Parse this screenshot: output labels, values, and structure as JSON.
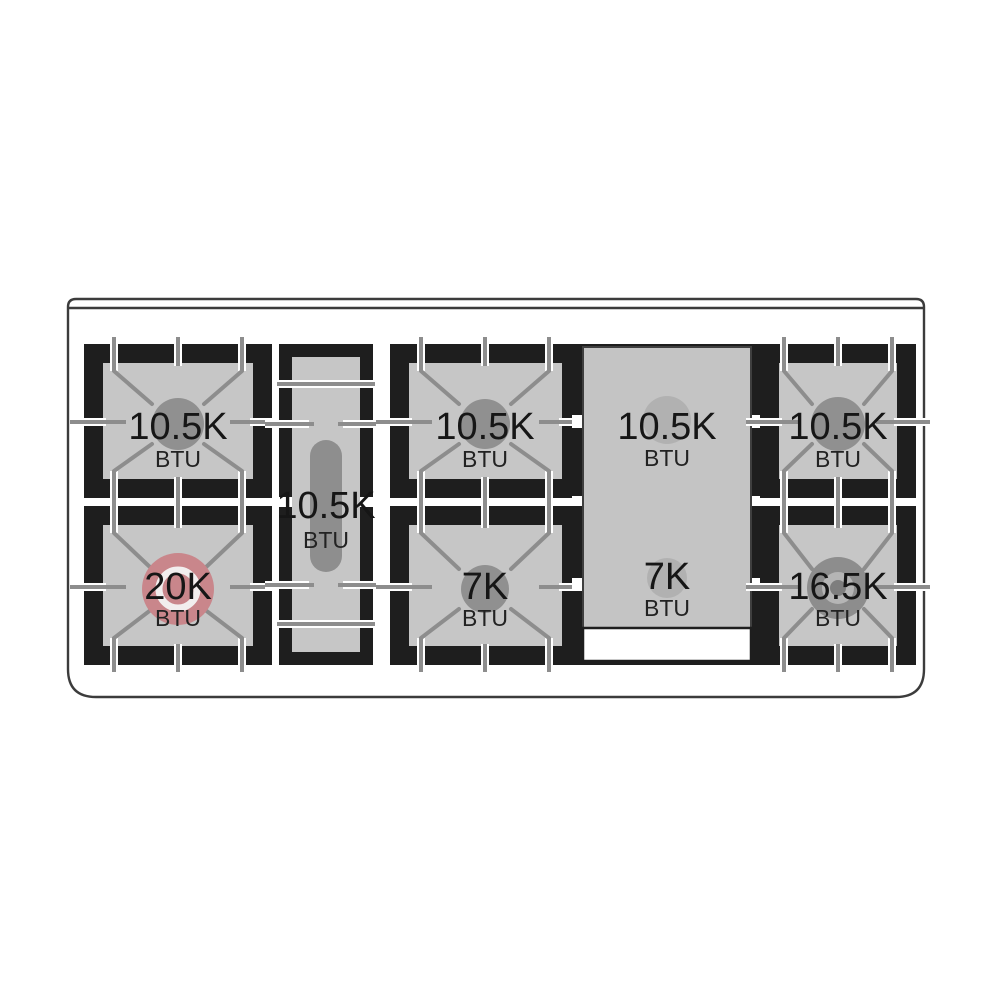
{
  "figure": {
    "kind": "range-cooktop-burner-diagram"
  },
  "colors": {
    "frame": "#1e1e1e",
    "surface": "#c6c6c6",
    "grate_line": "#8d8d8d",
    "burner_gray": "#909090",
    "burner_red": "#c9868b",
    "burner_red_ring": "#f2eeee",
    "dual_outer": "#8d8d8d",
    "dual_mid": "#b5b5b5",
    "dual_center": "#7e7e7e",
    "griddle_surface": "#c4c4c4",
    "griddle_spot": "#b1b1b1",
    "griddle_border": "#3f3f3f",
    "outline": "#3c3c3c",
    "oval_burner": "#8e8e8e"
  },
  "burners": [
    {
      "name": "rear-left",
      "power": "10.5K",
      "unit": "BTU",
      "type": "standard"
    },
    {
      "name": "front-left",
      "power": "20K",
      "unit": "BTU",
      "type": "high-power-red"
    },
    {
      "name": "center-left-oval",
      "power": "10.5K",
      "unit": "BTU",
      "type": "oval"
    },
    {
      "name": "rear-center",
      "power": "10.5K",
      "unit": "BTU",
      "type": "standard"
    },
    {
      "name": "front-center",
      "power": "7K",
      "unit": "BTU",
      "type": "standard"
    },
    {
      "name": "griddle-rear",
      "power": "10.5K",
      "unit": "BTU",
      "type": "under-griddle"
    },
    {
      "name": "griddle-front",
      "power": "7K",
      "unit": "BTU",
      "type": "under-griddle"
    },
    {
      "name": "rear-right",
      "power": "10.5K",
      "unit": "BTU",
      "type": "standard"
    },
    {
      "name": "front-right",
      "power": "16.5K",
      "unit": "BTU",
      "type": "dual-ring"
    }
  ]
}
